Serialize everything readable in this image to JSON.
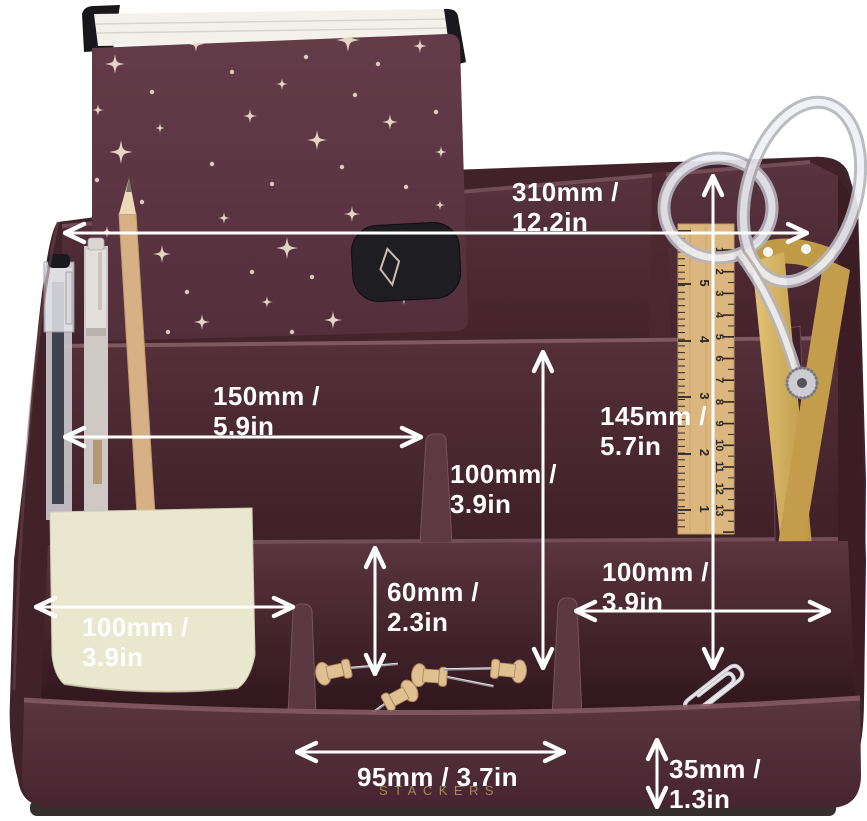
{
  "scene": {
    "description": "Burgundy Stackers desk organizer product photo with stationery (notebook, pens, pencil, sticky notes, ruler, scissors, push pins, paper clips) and white dimension annotations",
    "background_color": "#ffffff"
  },
  "brand": {
    "label": "STACKERS",
    "color": "#a4895a"
  },
  "annotations": {
    "overall_width": {
      "line1": "310mm /",
      "line2": "12.2in"
    },
    "left_compartment_width": {
      "line1": "150mm /",
      "line2": "5.9in"
    },
    "middle_depth": {
      "line1": "100mm /",
      "line2": "3.9in"
    },
    "overall_height": {
      "line1": "145mm /",
      "line2": "5.7in"
    },
    "sticky_width": {
      "line1": "100mm /",
      "line2": "3.9in"
    },
    "divider_height": {
      "line1": "60mm /",
      "line2": "2.3in"
    },
    "right_width": {
      "line1": "100mm /",
      "line2": "3.9in"
    },
    "front_middle_width": {
      "line1": "95mm / 3.7in",
      "line2": ""
    },
    "base_height": {
      "line1": "35mm /",
      "line2": "1.3in"
    }
  },
  "ruler": {
    "inch_numbers": [
      "5",
      "4",
      "3",
      "2",
      "1"
    ],
    "cm_numbers": [
      "1",
      "2",
      "3",
      "4",
      "5",
      "6",
      "7",
      "8",
      "9",
      "10",
      "11",
      "12",
      "13"
    ]
  },
  "palette": {
    "organizer_body": "#41212a",
    "back_wall": "#583440",
    "mid_wall": "#553039",
    "tray": "#5b353f",
    "front_face": "#5a3640",
    "rim_highlight": "#7d5660",
    "annotation": "#ffffff",
    "notebook_cover": "#5b3441",
    "notebook_star": "#ecdccb",
    "sticky_note": "#e9e7cd",
    "ruler_wood": "#dcb67f",
    "scissor_gold": "#c9a44f",
    "pin_wood": "#e0c091",
    "clip_silver": "#cfd0d5"
  }
}
